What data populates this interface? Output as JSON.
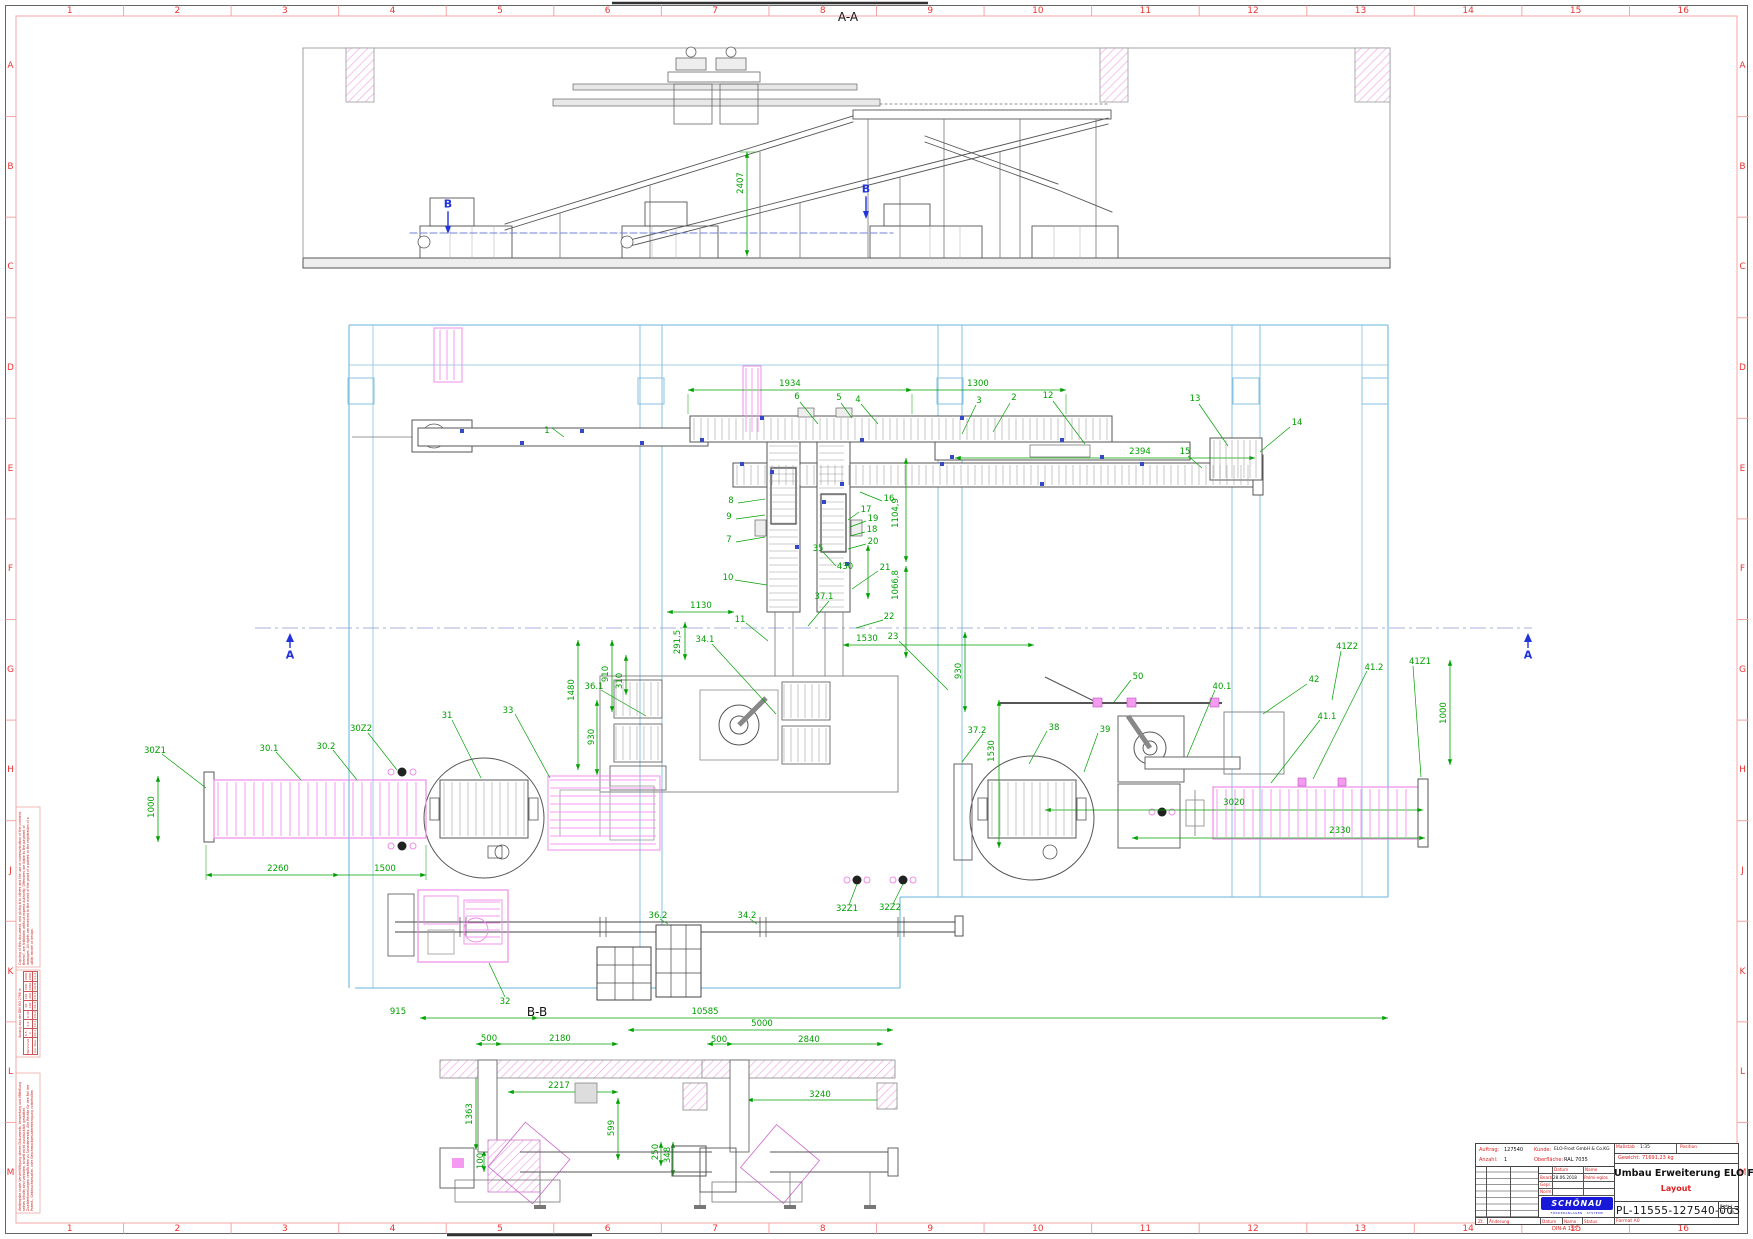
{
  "colors": {
    "dim_green": "#00a000",
    "grid_red": "#ee3333",
    "frame_salmon": "#f5a5a5",
    "building_blue": "#85c2e2",
    "highlight_magenta": "#ef8cea",
    "section_blue": "#2233dd",
    "logo_blue": "#1818d8"
  },
  "border": {
    "columns": [
      "1",
      "2",
      "3",
      "4",
      "5",
      "6",
      "7",
      "8",
      "9",
      "10",
      "11",
      "12",
      "13",
      "14",
      "15",
      "16"
    ],
    "rows": [
      "A",
      "B",
      "C",
      "D",
      "E",
      "F",
      "G",
      "H",
      "J",
      "K",
      "L",
      "M"
    ]
  },
  "titleblock": {
    "auftrag_label": "Auftrag:",
    "auftrag": "127540",
    "kunde_label": "Kunde:",
    "kunde": "ELO-Frost GmbH & Co.KG",
    "anzahl_label": "Anzahl:",
    "anzahl": "1",
    "oberflaeche_label": "Oberfläche:",
    "oberflaeche": "RAL 7035",
    "massstab_label": "Maßstab",
    "massstab": "1:35",
    "position_label": "Position",
    "position": "",
    "gewicht_label": "Gewicht:",
    "gewicht": "71691,23 kg",
    "datum_label": "Datum",
    "name_label": "Name",
    "rows": [
      {
        "role": "Bearb.",
        "datum": "28.06.2018",
        "name": "Palmi-eglos"
      },
      {
        "role": "Gepr.",
        "datum": "",
        "name": ""
      },
      {
        "role": "Norm",
        "datum": "",
        "name": ""
      }
    ],
    "title": "Umbau Erweiterung ELO Frost",
    "subtitle": "Layout",
    "number": "PL-11555-127540-003",
    "blatt": "Blatt 1",
    "blatt_count": "1",
    "blatt_unit": "Bl.",
    "format": "Format A0",
    "footer": {
      "zt": "Zt.",
      "aenderung": "Änderung",
      "datum": "Datum",
      "name": "Name",
      "status": "Status"
    },
    "din_note": "DIN-A 155",
    "logo": {
      "text": "SCHÖNAU",
      "sub": "FÖRDERANLAGEN · SYSTEME"
    }
  },
  "margin_notes": {
    "copyright_en": "Copying of this document, and giving it to others and the use or communication of the contents thereof, are forbidden without express authority. Offenders are liable to the payment of damages. All rights are reserved in the event of the grant of a patent or the registration of a utility model or design.",
    "copyright_de": "Weitergabe sowie Vervielfältigung dieses Dokuments, Verwertung und Mitteilung seines Inhalts sind verboten, soweit nicht ausdrücklich gestattet. Zuwiderhandlungen verpflichten zu Schadenersatz. Alle Rechte für den Fall der Patent-, Gebrauchsmuster- oder Geschmacksmustereintragung vorbehalten.",
    "tolerance": {
      "title": "Auszug aus der DIN ISO 2768 m",
      "row1_label": "Nennmaß",
      "row2_label": "zul. Abw.",
      "ranges": [
        "0,5-3",
        "3-6",
        "6-30",
        "30-120",
        "120-400",
        "400-1000",
        "1000-2000"
      ],
      "values": [
        "±0,1",
        "±0,1",
        "±0,2",
        "±0,3",
        "±0,5",
        "±0,8",
        "±1,2"
      ]
    }
  },
  "annotations": [
    {
      "t": "A-A",
      "x": 848,
      "y": 17,
      "c": "k"
    },
    {
      "t": "B-B",
      "x": 537,
      "y": 1012,
      "c": "k"
    },
    {
      "t": "B",
      "x": 448,
      "y": 204,
      "c": "b"
    },
    {
      "t": "B",
      "x": 866,
      "y": 189,
      "c": "b"
    },
    {
      "t": "A",
      "x": 290,
      "y": 655,
      "c": "b"
    },
    {
      "t": "A",
      "x": 1528,
      "y": 655,
      "c": "b"
    },
    {
      "t": "2407",
      "x": 741,
      "y": 183,
      "c": "g",
      "r": -90
    },
    {
      "t": "1934",
      "x": 790,
      "y": 384,
      "c": "g"
    },
    {
      "t": "1300",
      "x": 978,
      "y": 384,
      "c": "g"
    },
    {
      "t": "6",
      "x": 797,
      "y": 397,
      "c": "g"
    },
    {
      "t": "5",
      "x": 839,
      "y": 398,
      "c": "g"
    },
    {
      "t": "4",
      "x": 858,
      "y": 400,
      "c": "g"
    },
    {
      "t": "3",
      "x": 979,
      "y": 401,
      "c": "g"
    },
    {
      "t": "2",
      "x": 1014,
      "y": 398,
      "c": "g"
    },
    {
      "t": "12",
      "x": 1048,
      "y": 396,
      "c": "g"
    },
    {
      "t": "13",
      "x": 1195,
      "y": 399,
      "c": "g"
    },
    {
      "t": "14",
      "x": 1297,
      "y": 423,
      "c": "g"
    },
    {
      "t": "1",
      "x": 547,
      "y": 431,
      "c": "g"
    },
    {
      "t": "2394",
      "x": 1140,
      "y": 452,
      "c": "g"
    },
    {
      "t": "15",
      "x": 1185,
      "y": 452,
      "c": "g"
    },
    {
      "t": "16",
      "x": 889,
      "y": 499,
      "c": "g"
    },
    {
      "t": "17",
      "x": 866,
      "y": 510,
      "c": "g"
    },
    {
      "t": "19",
      "x": 873,
      "y": 519,
      "c": "g"
    },
    {
      "t": "18",
      "x": 872,
      "y": 530,
      "c": "g"
    },
    {
      "t": "20",
      "x": 873,
      "y": 542,
      "c": "g"
    },
    {
      "t": "21",
      "x": 885,
      "y": 568,
      "c": "g"
    },
    {
      "t": "8",
      "x": 731,
      "y": 501,
      "c": "g"
    },
    {
      "t": "9",
      "x": 729,
      "y": 517,
      "c": "g"
    },
    {
      "t": "7",
      "x": 729,
      "y": 540,
      "c": "g"
    },
    {
      "t": "10",
      "x": 728,
      "y": 578,
      "c": "g"
    },
    {
      "t": "1104,9",
      "x": 896,
      "y": 513,
      "c": "g",
      "r": -90
    },
    {
      "t": "1066,8",
      "x": 896,
      "y": 585,
      "c": "g",
      "r": -90
    },
    {
      "t": "1130",
      "x": 701,
      "y": 606,
      "c": "g"
    },
    {
      "t": "11",
      "x": 740,
      "y": 620,
      "c": "g"
    },
    {
      "t": "291,5",
      "x": 678,
      "y": 642,
      "c": "g",
      "r": -90
    },
    {
      "t": "34.1",
      "x": 705,
      "y": 640,
      "c": "g"
    },
    {
      "t": "22",
      "x": 889,
      "y": 617,
      "c": "g"
    },
    {
      "t": "1530",
      "x": 867,
      "y": 639,
      "c": "g"
    },
    {
      "t": "23",
      "x": 893,
      "y": 637,
      "c": "g"
    },
    {
      "t": "35",
      "x": 818,
      "y": 549,
      "c": "g"
    },
    {
      "t": "430",
      "x": 845,
      "y": 567,
      "c": "g"
    },
    {
      "t": "37.1",
      "x": 824,
      "y": 597,
      "c": "g"
    },
    {
      "t": "36.1",
      "x": 594,
      "y": 687,
      "c": "g"
    },
    {
      "t": "1480",
      "x": 572,
      "y": 690,
      "c": "g",
      "r": -90
    },
    {
      "t": "910",
      "x": 606,
      "y": 674,
      "c": "g",
      "r": -90
    },
    {
      "t": "310",
      "x": 620,
      "y": 681,
      "c": "g",
      "r": -90
    },
    {
      "t": "930",
      "x": 592,
      "y": 737,
      "c": "g",
      "r": -90
    },
    {
      "t": "37.2",
      "x": 977,
      "y": 731,
      "c": "g"
    },
    {
      "t": "1530",
      "x": 992,
      "y": 751,
      "c": "g",
      "r": -90
    },
    {
      "t": "930",
      "x": 959,
      "y": 671,
      "c": "g",
      "r": -90
    },
    {
      "t": "38",
      "x": 1054,
      "y": 728,
      "c": "g"
    },
    {
      "t": "39",
      "x": 1105,
      "y": 730,
      "c": "g"
    },
    {
      "t": "50",
      "x": 1138,
      "y": 677,
      "c": "g"
    },
    {
      "t": "40.1",
      "x": 1222,
      "y": 687,
      "c": "g"
    },
    {
      "t": "42",
      "x": 1314,
      "y": 680,
      "c": "g"
    },
    {
      "t": "41.1",
      "x": 1327,
      "y": 717,
      "c": "g"
    },
    {
      "t": "41Z2",
      "x": 1347,
      "y": 647,
      "c": "g"
    },
    {
      "t": "41.2",
      "x": 1374,
      "y": 668,
      "c": "g"
    },
    {
      "t": "41Z1",
      "x": 1420,
      "y": 662,
      "c": "g"
    },
    {
      "t": "1000",
      "x": 1444,
      "y": 713,
      "c": "g",
      "r": -90
    },
    {
      "t": "3020",
      "x": 1234,
      "y": 803,
      "c": "g"
    },
    {
      "t": "2330",
      "x": 1340,
      "y": 831,
      "c": "g"
    },
    {
      "t": "30Z1",
      "x": 155,
      "y": 751,
      "c": "g"
    },
    {
      "t": "30.1",
      "x": 269,
      "y": 749,
      "c": "g"
    },
    {
      "t": "30.2",
      "x": 326,
      "y": 747,
      "c": "g"
    },
    {
      "t": "30Z2",
      "x": 361,
      "y": 729,
      "c": "g"
    },
    {
      "t": "31",
      "x": 447,
      "y": 716,
      "c": "g"
    },
    {
      "t": "33",
      "x": 508,
      "y": 711,
      "c": "g"
    },
    {
      "t": "1000",
      "x": 152,
      "y": 807,
      "c": "g",
      "r": -90
    },
    {
      "t": "2260",
      "x": 278,
      "y": 869,
      "c": "g"
    },
    {
      "t": "1500",
      "x": 385,
      "y": 869,
      "c": "g"
    },
    {
      "t": "32Z1",
      "x": 847,
      "y": 909,
      "c": "g"
    },
    {
      "t": "32Z2",
      "x": 890,
      "y": 908,
      "c": "g"
    },
    {
      "t": "36.2",
      "x": 658,
      "y": 916,
      "c": "g"
    },
    {
      "t": "34.2",
      "x": 747,
      "y": 916,
      "c": "g"
    },
    {
      "t": "32",
      "x": 505,
      "y": 1002,
      "c": "g"
    },
    {
      "t": "915",
      "x": 398,
      "y": 1012,
      "c": "g"
    },
    {
      "t": "10585",
      "x": 705,
      "y": 1012,
      "c": "g"
    },
    {
      "t": "5000",
      "x": 762,
      "y": 1024,
      "c": "g"
    },
    {
      "t": "500",
      "x": 489,
      "y": 1039,
      "c": "g"
    },
    {
      "t": "2180",
      "x": 560,
      "y": 1039,
      "c": "g"
    },
    {
      "t": "500",
      "x": 719,
      "y": 1040,
      "c": "g"
    },
    {
      "t": "2840",
      "x": 809,
      "y": 1040,
      "c": "g"
    },
    {
      "t": "2217",
      "x": 559,
      "y": 1086,
      "c": "g"
    },
    {
      "t": "3240",
      "x": 820,
      "y": 1095,
      "c": "g"
    },
    {
      "t": "1363",
      "x": 470,
      "y": 1114,
      "c": "g",
      "r": -90
    },
    {
      "t": "599",
      "x": 612,
      "y": 1128,
      "c": "g",
      "r": -90
    },
    {
      "t": "250",
      "x": 656,
      "y": 1152,
      "c": "g",
      "r": -90
    },
    {
      "t": "348",
      "x": 668,
      "y": 1155,
      "c": "g",
      "r": -90
    },
    {
      "t": "100",
      "x": 481,
      "y": 1161,
      "c": "g",
      "r": -90
    }
  ]
}
